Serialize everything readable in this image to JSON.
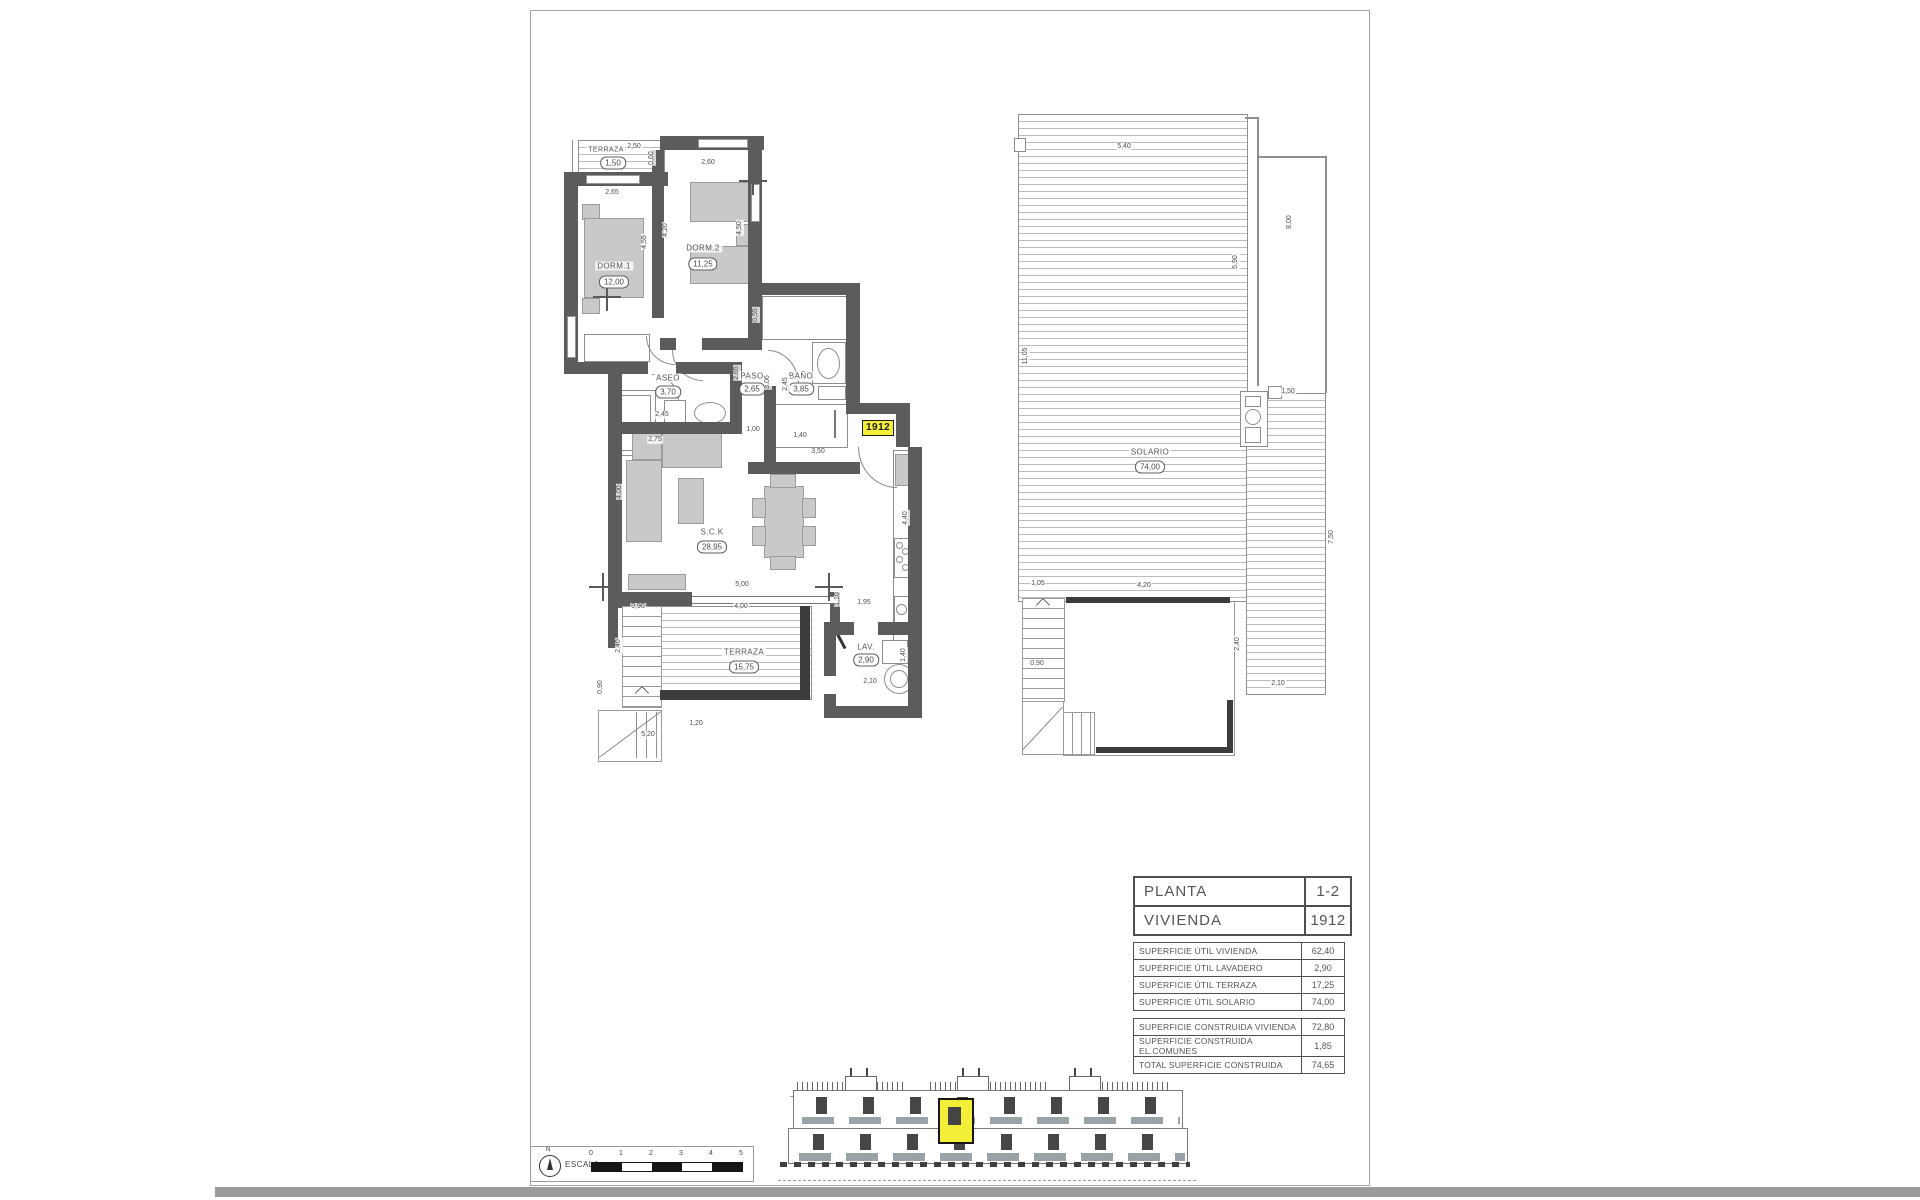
{
  "unit": "1912",
  "apartment": {
    "rooms": {
      "terraza_top": {
        "name": "TERRAZA",
        "area": "1,50"
      },
      "dorm1": {
        "name": "DORM.1",
        "area": "12,00"
      },
      "dorm2": {
        "name": "DORM.2",
        "area": "11,25"
      },
      "aseo": {
        "name": "ASEO",
        "area": "3,70"
      },
      "paso": {
        "name": "PASO",
        "area": "2,65"
      },
      "bano": {
        "name": "BAÑO",
        "area": "3,85"
      },
      "sck": {
        "name": "S.C.K",
        "area": "28,95"
      },
      "terraza": {
        "name": "TERRAZA",
        "area": "15,75"
      },
      "lav": {
        "name": "LAV.",
        "area": "2,90"
      }
    },
    "dims": [
      {
        "t": "2,50",
        "x": 634,
        "y": 147,
        "r": 0
      },
      {
        "t": "0,60",
        "x": 652,
        "y": 158,
        "r": 90
      },
      {
        "t": "2,65",
        "x": 612,
        "y": 193,
        "r": 0
      },
      {
        "t": "2,60",
        "x": 708,
        "y": 163,
        "r": 0
      },
      {
        "t": "4,55",
        "x": 645,
        "y": 242,
        "r": 90
      },
      {
        "t": "4,20",
        "x": 666,
        "y": 230,
        "r": 90
      },
      {
        "t": "4,50",
        "x": 740,
        "y": 228,
        "r": 90
      },
      {
        "t": "0,55",
        "x": 756,
        "y": 315,
        "r": 90
      },
      {
        "t": "2,65",
        "x": 737,
        "y": 373,
        "r": 90
      },
      {
        "t": "3,06",
        "x": 768,
        "y": 382,
        "r": 90
      },
      {
        "t": "2,45",
        "x": 662,
        "y": 415,
        "r": 0
      },
      {
        "t": "2,75",
        "x": 655,
        "y": 440,
        "r": 0
      },
      {
        "t": "2,45",
        "x": 786,
        "y": 384,
        "r": 90
      },
      {
        "t": "1,00",
        "x": 753,
        "y": 430,
        "r": 0
      },
      {
        "t": "1,40",
        "x": 800,
        "y": 436,
        "r": 0
      },
      {
        "t": "3,50",
        "x": 818,
        "y": 452,
        "r": 0
      },
      {
        "t": "4,40",
        "x": 906,
        "y": 518,
        "r": 90
      },
      {
        "t": "4,00",
        "x": 620,
        "y": 492,
        "r": 90
      },
      {
        "t": "5,00",
        "x": 742,
        "y": 585,
        "r": 0
      },
      {
        "t": "4,00",
        "x": 741,
        "y": 607,
        "r": 0
      },
      {
        "t": "0,90",
        "x": 638,
        "y": 607,
        "r": 0
      },
      {
        "t": "2,40",
        "x": 619,
        "y": 646,
        "r": 90
      },
      {
        "t": "1,10",
        "x": 838,
        "y": 599,
        "r": 90
      },
      {
        "t": "1,95",
        "x": 864,
        "y": 603,
        "r": 0
      },
      {
        "t": "2,10",
        "x": 870,
        "y": 682,
        "r": 0
      },
      {
        "t": "1,40",
        "x": 904,
        "y": 655,
        "r": 90
      },
      {
        "t": "0,90",
        "x": 601,
        "y": 687,
        "r": 90
      },
      {
        "t": "5,20",
        "x": 648,
        "y": 735,
        "r": 0
      },
      {
        "t": "1,20",
        "x": 696,
        "y": 724,
        "r": 0
      }
    ]
  },
  "solario": {
    "room": {
      "name": "SOLARIO",
      "area": "74,00"
    },
    "dims": [
      {
        "t": "5,40",
        "x": 1124,
        "y": 147,
        "r": 0
      },
      {
        "t": "11,05",
        "x": 1026,
        "y": 356,
        "r": 90
      },
      {
        "t": "5,90",
        "x": 1236,
        "y": 262,
        "r": 90
      },
      {
        "t": "8,00",
        "x": 1290,
        "y": 222,
        "r": 90
      },
      {
        "t": "1,50",
        "x": 1288,
        "y": 392,
        "r": 0
      },
      {
        "t": "7,50",
        "x": 1332,
        "y": 537,
        "r": 90
      },
      {
        "t": "1,05",
        "x": 1038,
        "y": 584,
        "r": 0
      },
      {
        "t": "4,20",
        "x": 1144,
        "y": 586,
        "r": 0
      },
      {
        "t": "0,90",
        "x": 1037,
        "y": 664,
        "r": 0
      },
      {
        "t": "2,40",
        "x": 1238,
        "y": 644,
        "r": 90
      },
      {
        "t": "2,10",
        "x": 1278,
        "y": 684,
        "r": 0
      }
    ]
  },
  "info_table": {
    "header": [
      {
        "label": "PLANTA",
        "value": "1-2"
      },
      {
        "label": "VIVIENDA",
        "value": "1912"
      }
    ],
    "superficie_util": [
      {
        "label": "SUPERFICIE ÚTIL VIVIENDA",
        "value": "62,40"
      },
      {
        "label": "SUPERFICIE ÚTIL LAVADERO",
        "value": "2,90"
      },
      {
        "label": "SUPERFICIE ÚTIL TERRAZA",
        "value": "17,25"
      },
      {
        "label": "SUPERFICIE ÚTIL SOLARIO",
        "value": "74,00"
      }
    ],
    "superficie_construida": [
      {
        "label": "SUPERFICIE CONSTRUIDA VIVIENDA",
        "value": "72,80"
      },
      {
        "label": "SUPERFICIE CONSTRUIDA EL.COMUNES",
        "value": "1,85"
      },
      {
        "label": "TOTAL SUPERFICIE CONSTRUIDA",
        "value": "74,65"
      }
    ]
  },
  "scale_bar": {
    "label": "ESCALA :",
    "north_label": "N",
    "ticks": [
      "0",
      "1",
      "2",
      "3",
      "4",
      "5"
    ]
  },
  "colors": {
    "wall": "#5c5c5c",
    "highlight_yellow": "#f3ef39",
    "furniture_gray": "#c9c9c9"
  }
}
